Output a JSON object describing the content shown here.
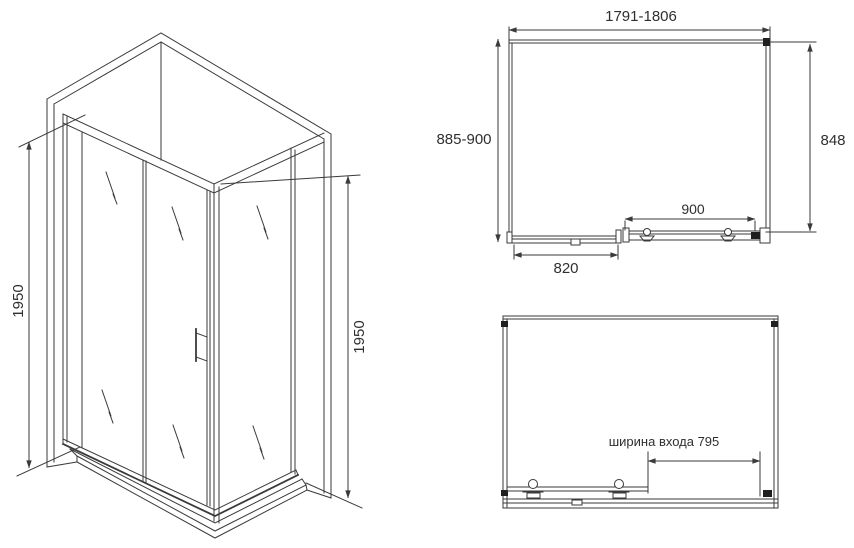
{
  "drawing": {
    "title": "shower enclosure dimensional drawing",
    "iso_view": {
      "height_left": "1950",
      "height_right": "1950"
    },
    "plan_view": {
      "width_range": "1791-1806",
      "depth_range": "885-900",
      "side_width": "848",
      "door_width": "900",
      "fixed_panel_width": "820"
    },
    "front_view": {
      "entrance_width_label": "ширина входа 795"
    }
  },
  "colors": {
    "line": "#3a3a3a",
    "text": "#2f2f2f",
    "background": "#ffffff"
  }
}
